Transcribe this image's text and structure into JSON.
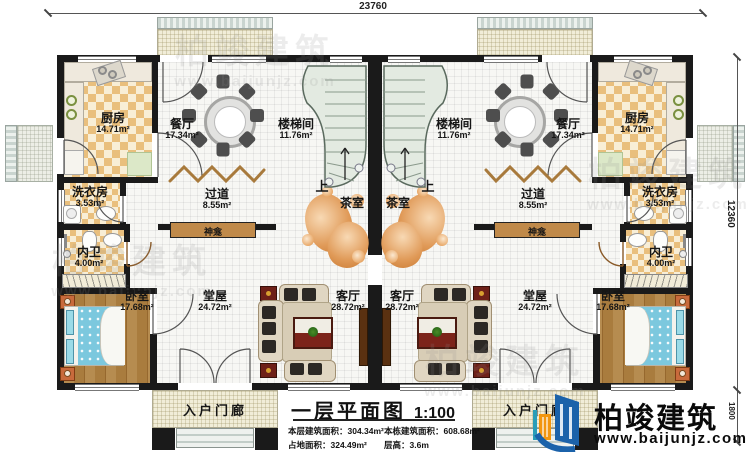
{
  "plan": {
    "title": "一层平面图",
    "scale": "1:100",
    "stats": {
      "floor_area": "本层建筑面积：304.34m²",
      "building_area": "本栋建筑面积：608.68m²",
      "footprint_area": "占地面积：324.49m²",
      "floor_height": "层高：3.6m"
    }
  },
  "dimensions": {
    "top_width": "23760",
    "right_height": "12360",
    "porch_depth": "1800"
  },
  "rooms": {
    "kitchen": {
      "name": "厨房",
      "area": "14.71m²"
    },
    "dining": {
      "name": "餐厅",
      "area": "17.34m²"
    },
    "stairwell": {
      "name": "楼梯间",
      "area": "11.76m²"
    },
    "laundry": {
      "name": "洗衣房",
      "area": "3.53m²"
    },
    "corridor": {
      "name": "过道",
      "area": "8.55m²"
    },
    "tea_room": {
      "name": "茶室"
    },
    "shrine": {
      "name": "神龛"
    },
    "bathroom": {
      "name": "内卫",
      "area": "4.00m²"
    },
    "bedroom": {
      "name": "卧室",
      "area": "17.68m²"
    },
    "hall": {
      "name": "堂屋",
      "area": "24.72m²"
    },
    "living": {
      "name": "客厅",
      "area": "28.72m²"
    },
    "porch": {
      "name": "入户门廊"
    },
    "up": "上"
  },
  "brand": {
    "name": "柏竣建筑",
    "website": "www.baijunjz.com"
  },
  "watermark": {
    "line1": "柏竣建筑",
    "line2": "www.baijunjz.com"
  },
  "colors": {
    "wall": "#1a1a1a",
    "brand_blue": "#1b62aa",
    "brand_orange": "#f2960f",
    "checker_tan": "#e9bf7d",
    "wood": "#a97c3e",
    "bed_blue": "#7cc8de"
  }
}
